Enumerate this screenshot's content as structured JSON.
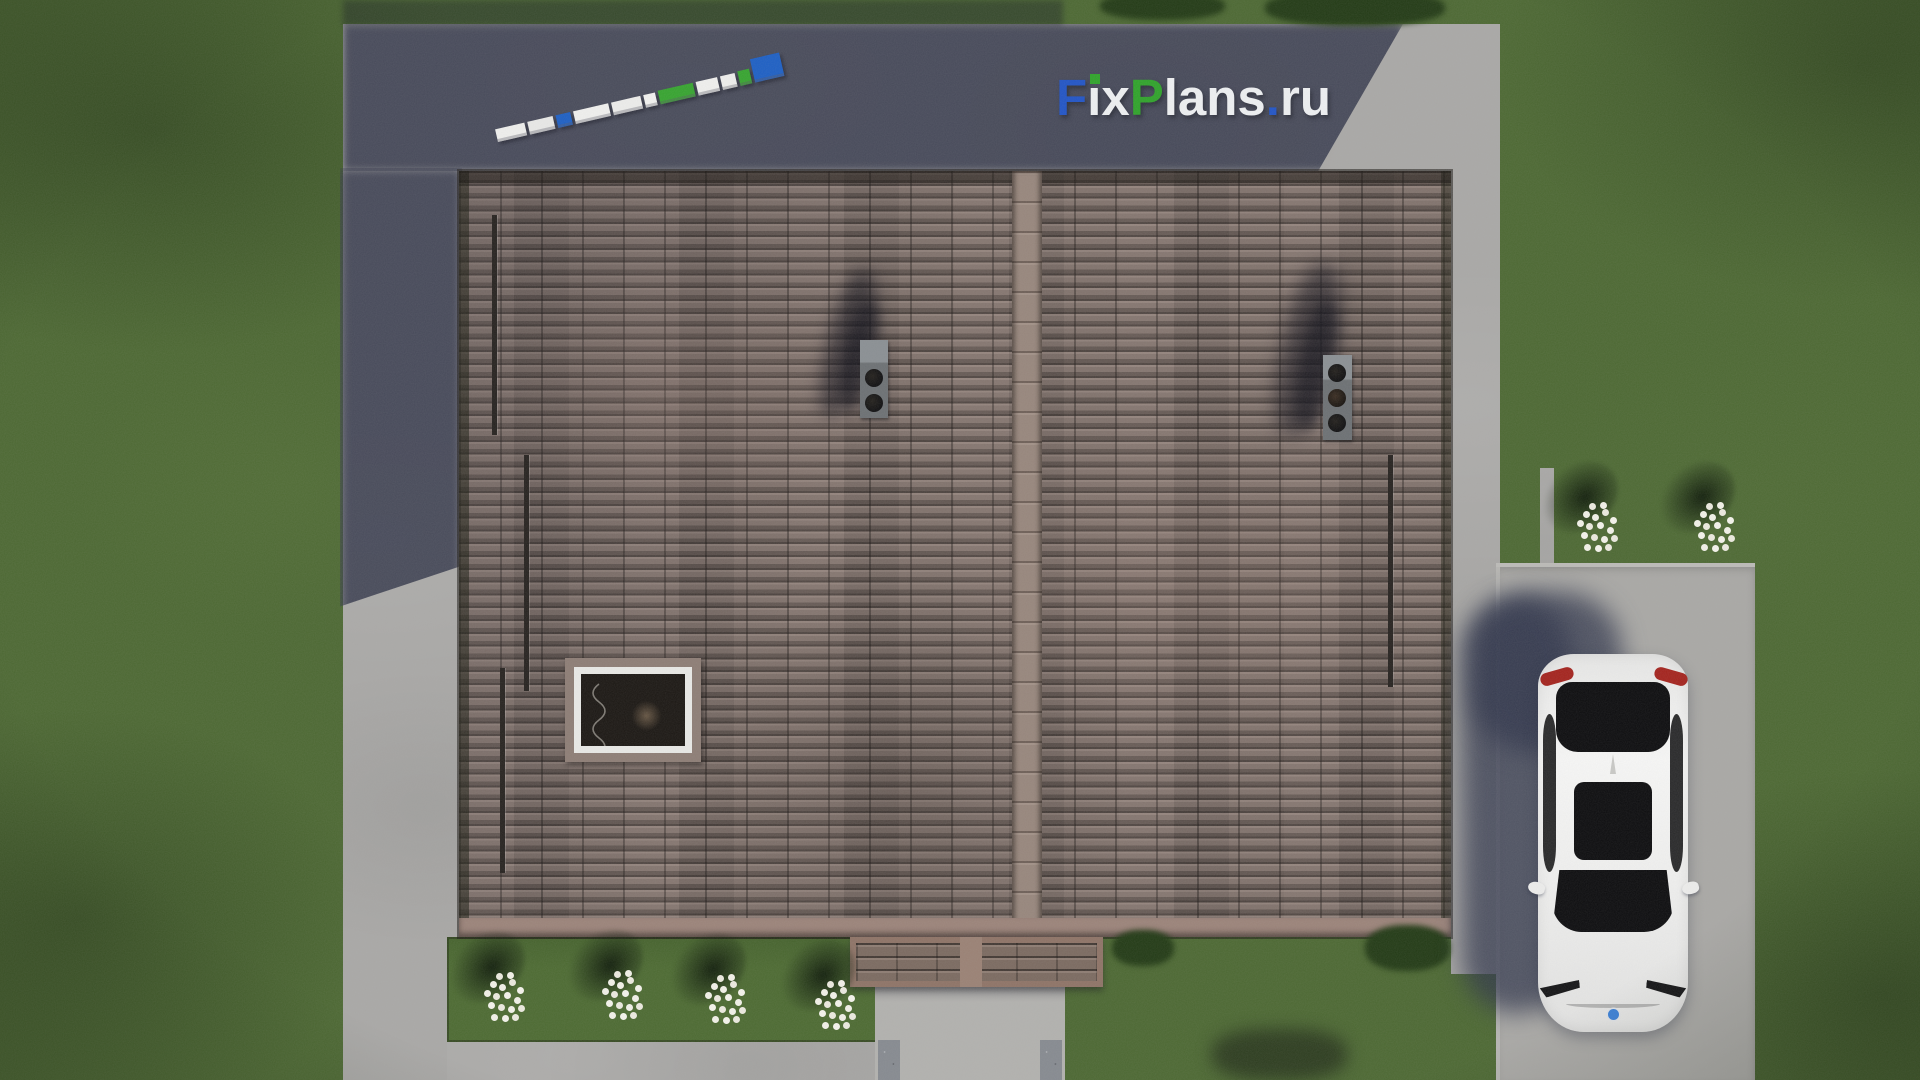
{
  "watermark": {
    "full_text": "FixPlans.ru",
    "f": "F",
    "i_dotless": "ı",
    "x": "x",
    "p": "P",
    "lans": "lans",
    "dot": ".",
    "ru": "ru",
    "color_blue": "#2154c6",
    "color_green": "#2fa32a",
    "color_white": "#eef0f2"
  },
  "scale_bar": {
    "segments": [
      {
        "w": 30,
        "h": 13,
        "c": "#efefed"
      },
      {
        "w": 26,
        "h": 13,
        "c": "#e9e9e7"
      },
      {
        "w": 15,
        "h": 13,
        "c": "#1d5fc4"
      },
      {
        "w": 36,
        "h": 13,
        "c": "#f0f0ee"
      },
      {
        "w": 30,
        "h": 13,
        "c": "#ededeb"
      },
      {
        "w": 12,
        "h": 13,
        "c": "#f2f2f0"
      },
      {
        "w": 36,
        "h": 14,
        "c": "#36a42f"
      },
      {
        "w": 22,
        "h": 14,
        "c": "#f0f0ee"
      },
      {
        "w": 15,
        "h": 14,
        "c": "#eeeeec"
      },
      {
        "w": 12,
        "h": 15,
        "c": "#36a42f"
      },
      {
        "w": 30,
        "h": 24,
        "c": "#1d5fc4"
      }
    ]
  },
  "scene": {
    "objects": [
      "house-roof-top-view",
      "roof-ridge",
      "chimney-two-flues",
      "chimney-three-flues",
      "roof-window",
      "snow-guard-bars",
      "entrance-porch-roof",
      "entrance-walkway",
      "paved-blind-area",
      "driveway-pad",
      "white-car-top-view",
      "car-shadow",
      "flower-clusters-white",
      "lawn",
      "bushes",
      "building-shadow",
      "scale-bar"
    ],
    "colors": {
      "grass": "#4c6832",
      "roof_tiles": "#7f716b",
      "roof_ridge": "#97867c",
      "pavement": "#a9a8a6",
      "building_shadow": "#363a4c",
      "car_body": "#f2f2f1",
      "car_taillight": "#a4231d",
      "car_badge": "#3a7fd5",
      "flowers": "#f2f1e8"
    }
  }
}
